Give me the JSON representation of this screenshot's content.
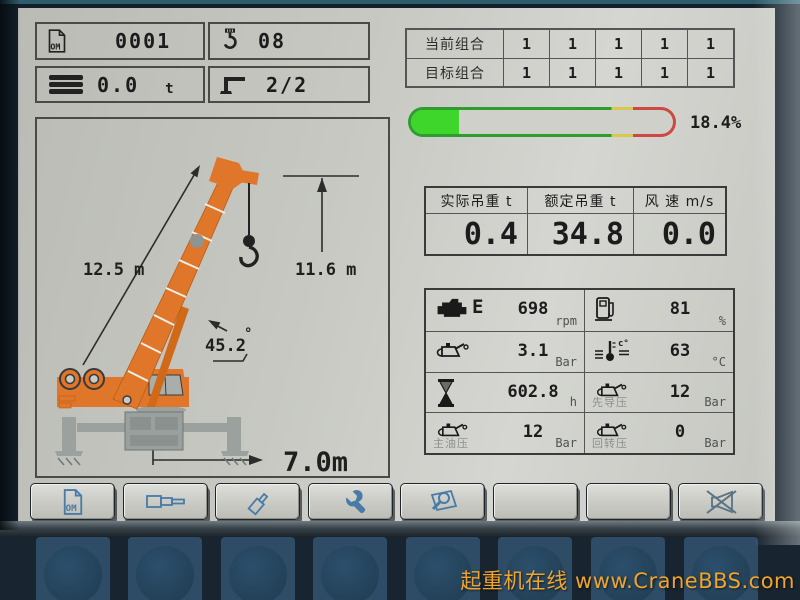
{
  "header": {
    "program": {
      "icon": "om-document-icon",
      "value": "0001"
    },
    "reeving": {
      "icon": "hook-icon",
      "value": "08"
    },
    "counterweight": {
      "icon": "counterweight-icon",
      "value": "0.0",
      "unit": "t"
    },
    "outriggers": {
      "icon": "outrigger-icon",
      "value": "2/2"
    }
  },
  "combo_table": {
    "rows": [
      {
        "label": "当前组合",
        "values": [
          "1",
          "1",
          "1",
          "1",
          "1"
        ]
      },
      {
        "label": "目标组合",
        "values": [
          "1",
          "1",
          "1",
          "1",
          "1"
        ]
      }
    ]
  },
  "utilization": {
    "percent": 18.4,
    "label": "18.4%"
  },
  "load_table": {
    "headers": [
      "实际吊重 t",
      "额定吊重 t",
      "风 速 m/s"
    ],
    "values": [
      "0.4",
      "34.8",
      "0.0"
    ]
  },
  "engine_table": {
    "cells": [
      {
        "icon": "engine-icon",
        "label": "E",
        "value": "698",
        "unit": "rpm"
      },
      {
        "icon": "fuel-level-icon",
        "label": "",
        "value": "81",
        "unit": "%"
      },
      {
        "icon": "oil-can-icon",
        "label": "",
        "value": "3.1",
        "unit": "Bar"
      },
      {
        "icon": "coolant-temperature-icon",
        "label": "",
        "value": "63",
        "unit": "°C"
      },
      {
        "icon": "hourglass-icon",
        "label": "",
        "value": "602.8",
        "unit": "h"
      },
      {
        "icon": "oil-can-icon",
        "label": "先导压",
        "value": "12",
        "unit": "Bar"
      },
      {
        "icon": "oil-can-icon",
        "label": "主油压",
        "value": "12",
        "unit": "Bar"
      },
      {
        "icon": "oil-can-icon",
        "label": "回转压",
        "value": "0",
        "unit": "Bar"
      }
    ]
  },
  "diagram": {
    "boom_length": "12.5 m",
    "hook_height": "11.6 m",
    "boom_angle": "45.2",
    "degree_symbol": "°",
    "radius": "7.0m"
  },
  "toolbar": {
    "buttons": [
      {
        "icon": "om-document-icon"
      },
      {
        "icon": "telescope-sections-icon"
      },
      {
        "icon": "hydraulic-cylinder-icon"
      },
      {
        "icon": "wrench-icon"
      },
      {
        "icon": "inspect-document-icon"
      },
      {
        "icon": "blank"
      },
      {
        "icon": "blank"
      },
      {
        "icon": "mute-speaker-icon"
      }
    ]
  },
  "watermark": {
    "site_name": "起重机在线",
    "url": "www.CraneBBS.com"
  },
  "colors": {
    "crane_orange": "#e0762a",
    "bar_fill_green": "#3ed62b",
    "bar_outline_green": "#2f9c2f",
    "bar_yellow": "#d6c94c",
    "bar_red": "#cc4840",
    "screen_gray": "#c7c8c2",
    "bezel_navy": "#131f2a",
    "keypad_blue": "#2e4c66",
    "toolbar_icon_blue": "#4a7ba6",
    "watermark_orange": "#f1a42c"
  }
}
